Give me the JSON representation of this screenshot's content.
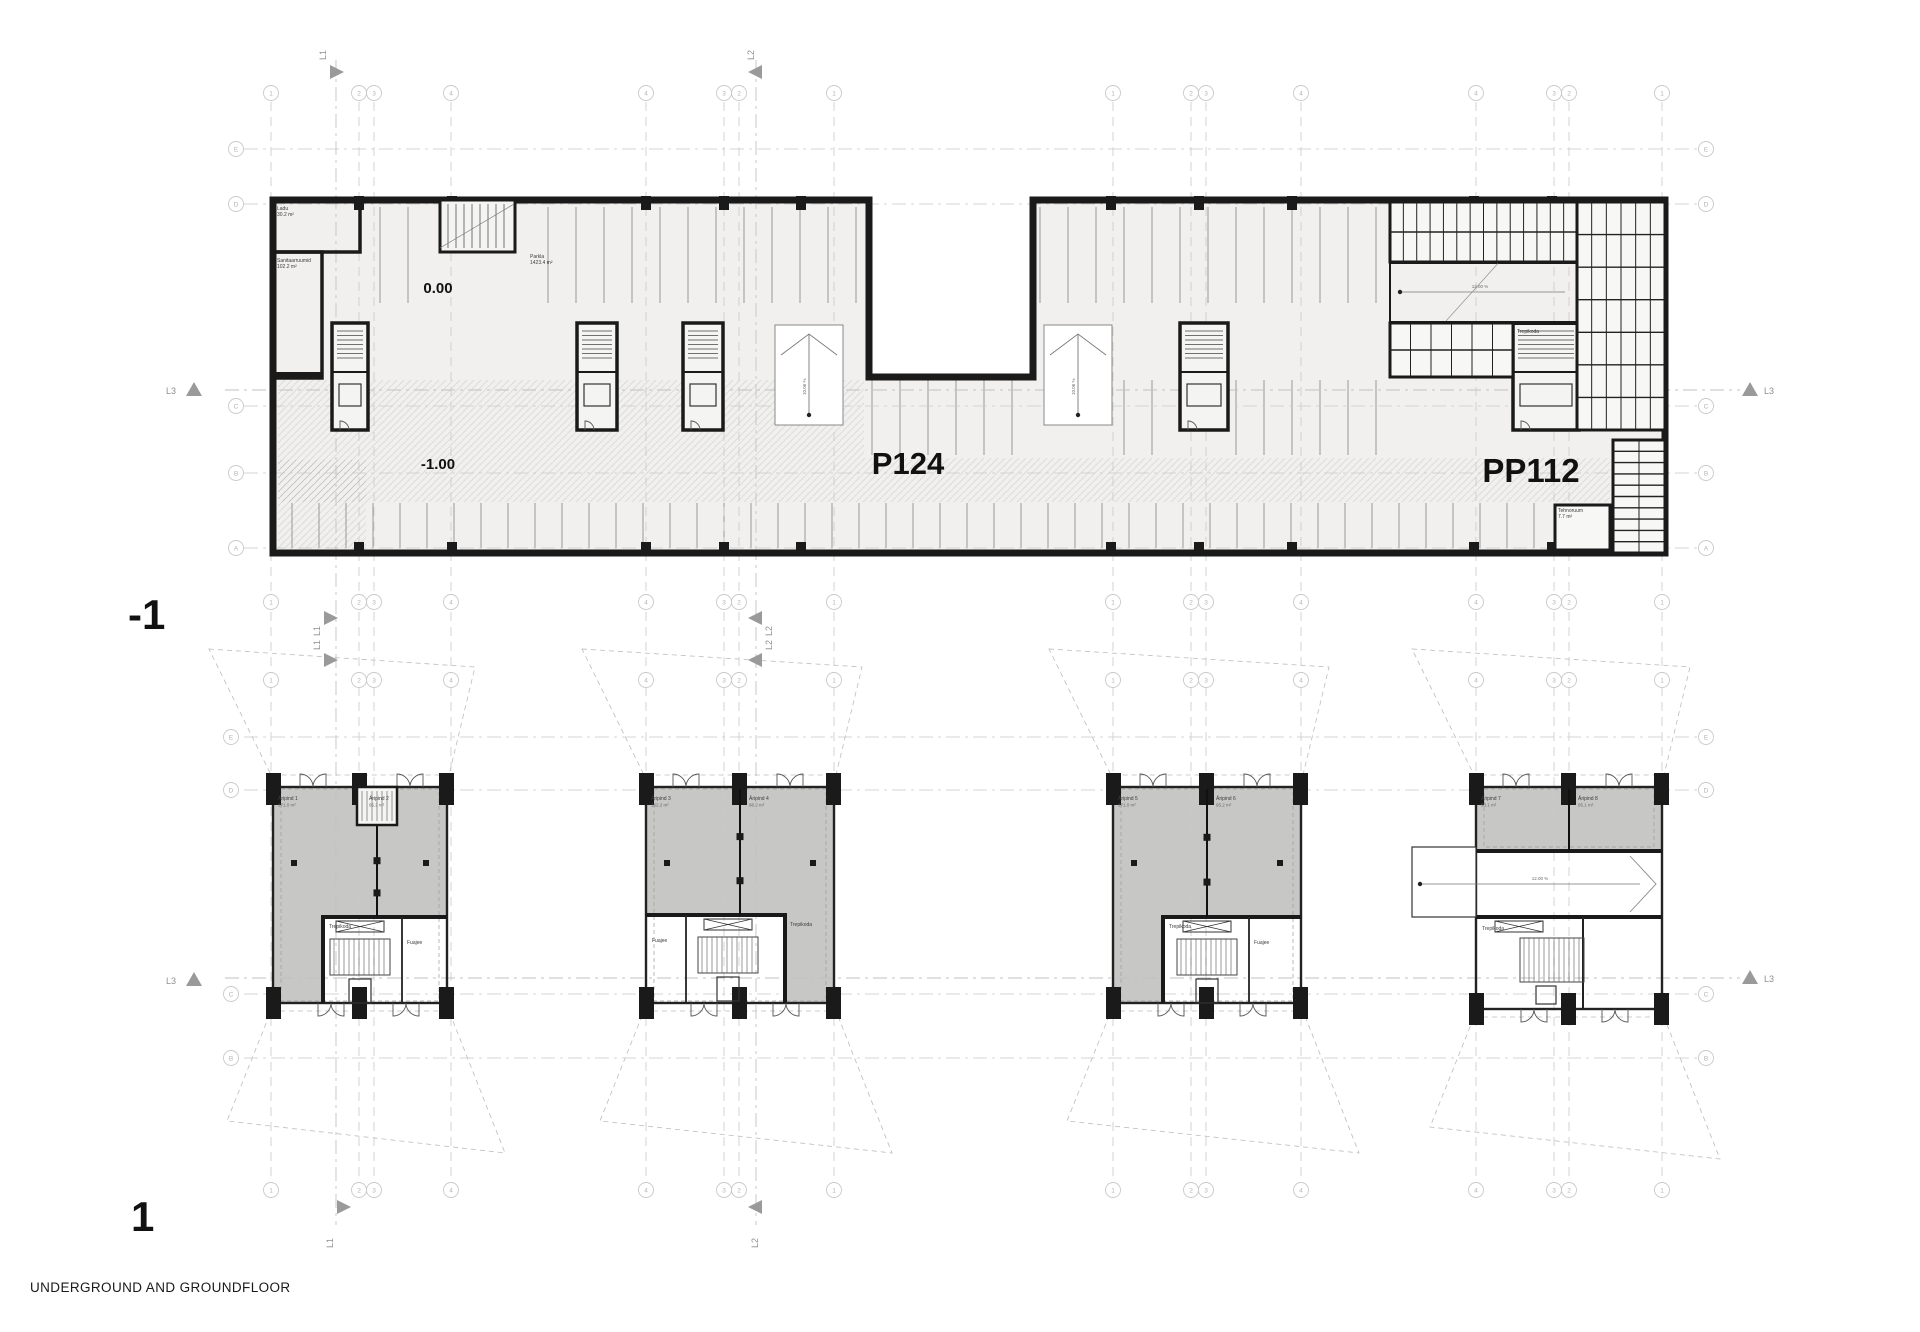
{
  "sheet": {
    "caption": "UNDERGROUND AND GROUNDFLOOR",
    "level_underground": "-1",
    "level_ground": "1"
  },
  "garage": {
    "elevation_upper": "0.00",
    "elevation_lower": "-1.00",
    "capacity_main": "P124",
    "capacity_secondary": "PP112",
    "ramp_left_slope": "10.06 %",
    "ramp_right_slope": "10.06 %",
    "ramp_storage_slope": "12.00 %",
    "rooms": {
      "storage": "Ladu",
      "storage_area": "30.2 m²",
      "sanitary": "Sanitaarruumid",
      "sanitary_area": "102.2 m²",
      "parking_hall": "Parkla",
      "parking_hall_area": "1423.4 m²",
      "tech_room": "Tehnoruum",
      "tech_room_area": "7.7 m²",
      "stairwell": "Trepikoda"
    }
  },
  "ground_floor": {
    "ramp_slope": "12.00 %",
    "blocks": [
      {
        "unit_left": "Äripind 1",
        "unit_left_area": "171.0 m²",
        "unit_right": "Äripind 2",
        "unit_right_area": "95.2 m²",
        "stairwell": "Trepikoda",
        "foyer": "Fuajee"
      },
      {
        "unit_left": "Äripind 3",
        "unit_left_area": "162.2 m²",
        "unit_right": "Äripind 4",
        "unit_right_area": "98.2 m²",
        "stairwell": "Trepikoda",
        "foyer": "Fuajee"
      },
      {
        "unit_left": "Äripind 5",
        "unit_left_area": "171.0 m²",
        "unit_right": "Äripind 6",
        "unit_right_area": "95.2 m²",
        "stairwell": "Trepikoda",
        "foyer": "Fuajee"
      },
      {
        "unit_left": "Äripind 7",
        "unit_left_area": "93.1 m²",
        "unit_right": "Äripind 8",
        "unit_right_area": "95.1 m²",
        "stairwell": "Trepikoda",
        "foyer": "Fuajee"
      }
    ]
  },
  "section_markers": {
    "l1": "L1",
    "l2": "L2",
    "l3": "L3"
  },
  "grid": {
    "column_labels": [
      "1",
      "2",
      "3",
      "4",
      "4",
      "3",
      "2",
      "1",
      "1",
      "2",
      "3",
      "4",
      "4",
      "3",
      "2",
      "1"
    ],
    "row_labels_upper": [
      "E",
      "D",
      "C",
      "B",
      "A"
    ],
    "row_labels_lower": [
      "E",
      "D",
      "C",
      "B"
    ]
  },
  "colors": {
    "wall": "#1a1a1a",
    "floor": "#f1f0ee",
    "unit_gray": "#c7c7c5",
    "grid_line": "#c9c9c9",
    "marker_gray": "#9a9a9a",
    "stall_line": "#8f8f8f"
  }
}
